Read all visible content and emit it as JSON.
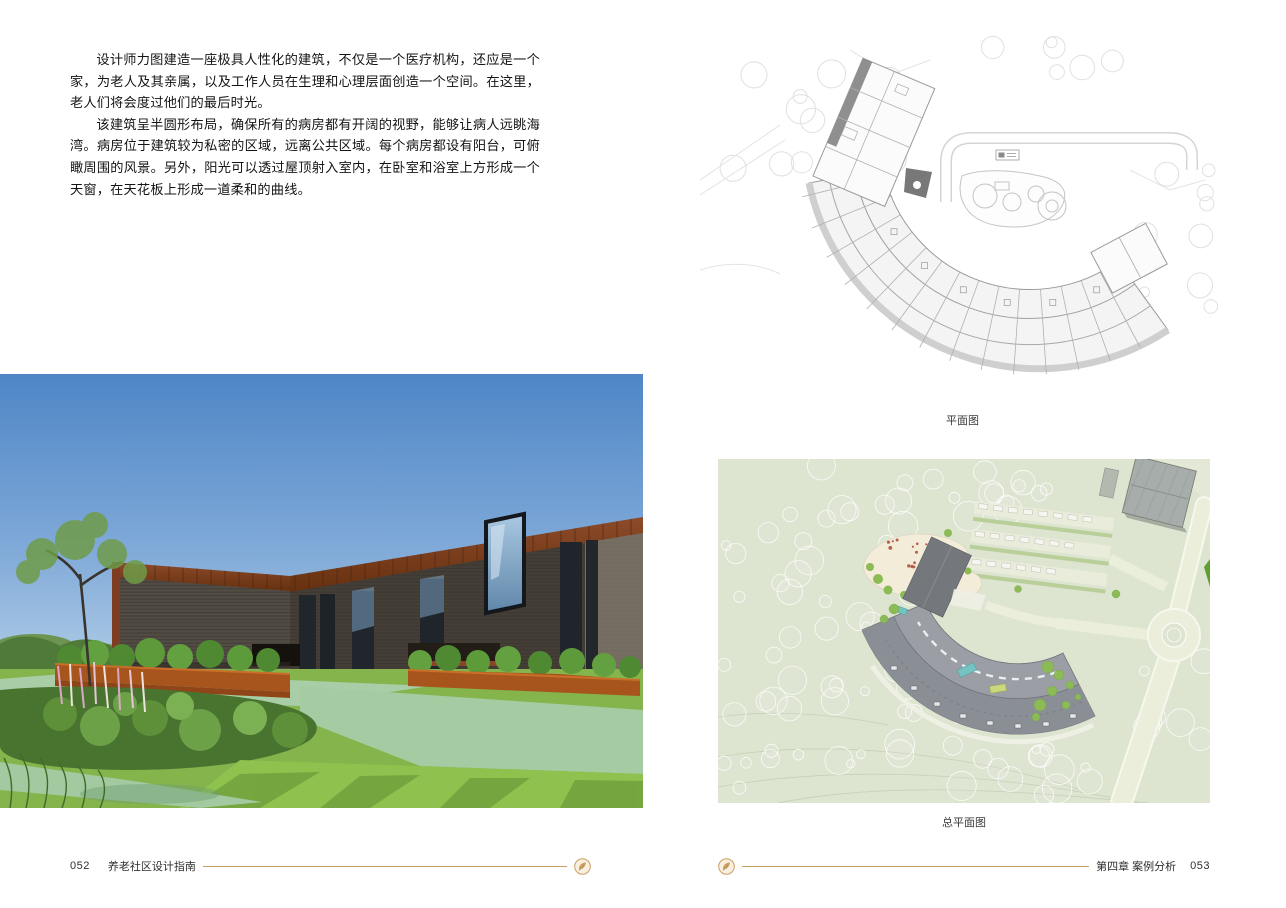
{
  "page": {
    "background": "#ffffff",
    "accent_gold": "#c9a063",
    "body_text_color": "#141414",
    "caption_color": "#3a3a3a"
  },
  "left_page": {
    "paragraphs": [
      "设计师力图建造一座极具人性化的建筑，不仅是一个医疗机构，还应是一个家，为老人及其亲属，以及工作人员在生理和心理层面创造一个空间。在这里，老人们将会度过他们的最后时光。",
      "该建筑呈半圆形布局，确保所有的病房都有开阔的视野，能够让病人远眺海湾。病房位于建筑较为私密的区域，远离公共区域。每个病房都设有阳台，可俯瞰周围的风景。另外，阳光可以透过屋顶射入室内，在卧室和浴室上方形成一个天窗，在天花板上形成一道柔和的曲线。"
    ],
    "footer": {
      "page_number": "052",
      "book_title": "养老社区设计指南"
    }
  },
  "right_page": {
    "figures": [
      {
        "caption": "平面图"
      },
      {
        "caption": "总平面图"
      }
    ],
    "footer": {
      "chapter_label": "第四章 案例分析",
      "page_number": "053"
    }
  }
}
